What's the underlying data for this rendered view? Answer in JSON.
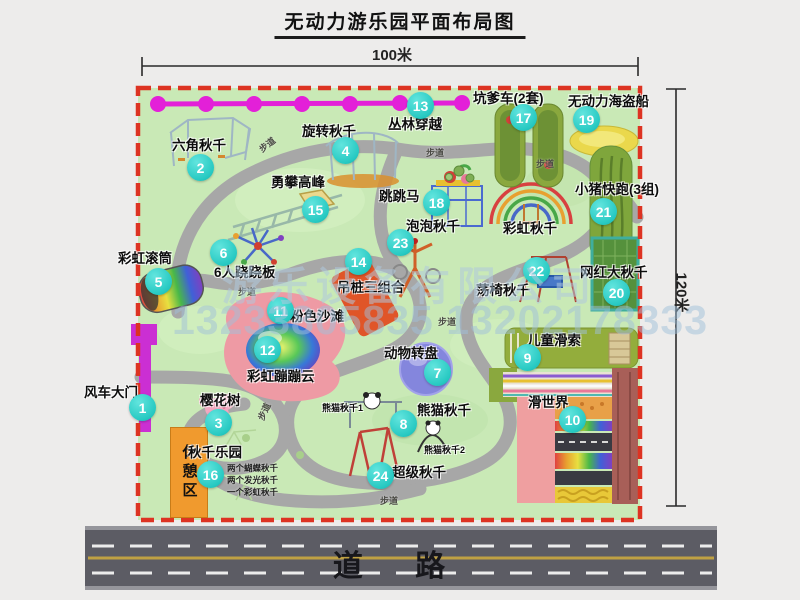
{
  "title": "无动力游乐园平面布局图",
  "dimensions": {
    "width_label": "100米",
    "height_label": "120米"
  },
  "road": {
    "label": "道  路"
  },
  "watermark": {
    "company": "游乐设备有限公司",
    "phone": "13233805835 13202178333"
  },
  "rest_area_label": "休憩区",
  "path_label": "步道",
  "extra_labels": {
    "rainbow_swing": "彩虹秋千",
    "panda_swing_1": "熊猫秋千1",
    "panda_swing_2": "熊猫秋千2"
  },
  "swing_park_details": [
    "两个蝴蝶秋千",
    "两个发光秋千",
    "一个彩虹秋千"
  ],
  "items": [
    {
      "num": "1",
      "label": "风车大门"
    },
    {
      "num": "2",
      "label": "六角秋千"
    },
    {
      "num": "3",
      "label": "樱花树"
    },
    {
      "num": "4",
      "label": "旋转秋千"
    },
    {
      "num": "5",
      "label": "彩虹滚筒"
    },
    {
      "num": "6",
      "label": "6人跷跷板"
    },
    {
      "num": "7",
      "label": "动物转盘"
    },
    {
      "num": "8",
      "label": "熊猫秋千"
    },
    {
      "num": "9",
      "label": "儿童滑索"
    },
    {
      "num": "10",
      "label": "滑世界"
    },
    {
      "num": "11",
      "label": "粉色沙滩"
    },
    {
      "num": "12",
      "label": "彩虹蹦蹦云"
    },
    {
      "num": "13",
      "label": "丛林穿越"
    },
    {
      "num": "14",
      "label": "吊桩三组合"
    },
    {
      "num": "15",
      "label": "勇攀高峰"
    },
    {
      "num": "16",
      "label": "秋千乐园"
    },
    {
      "num": "17",
      "label": "坑爹车(2套)"
    },
    {
      "num": "18",
      "label": "跳跳马"
    },
    {
      "num": "19",
      "label": "无动力海盗船"
    },
    {
      "num": "20",
      "label": "网红大秋千"
    },
    {
      "num": "21",
      "label": "小猪快跑(3组)"
    },
    {
      "num": "22",
      "label": "荡椅秋千"
    },
    {
      "num": "23",
      "label": "泡泡秋千"
    },
    {
      "num": "24",
      "label": "超级秋千"
    }
  ],
  "colors": {
    "map_green": "#c9e9b6",
    "border_red": "#dd3322",
    "badge_cyan": "#27c9c2",
    "zipline_magenta": "#e320d8",
    "gate_magenta": "#cb2fd3",
    "rest_orange": "#f09a2e",
    "road_gray": "#5c5c64"
  }
}
